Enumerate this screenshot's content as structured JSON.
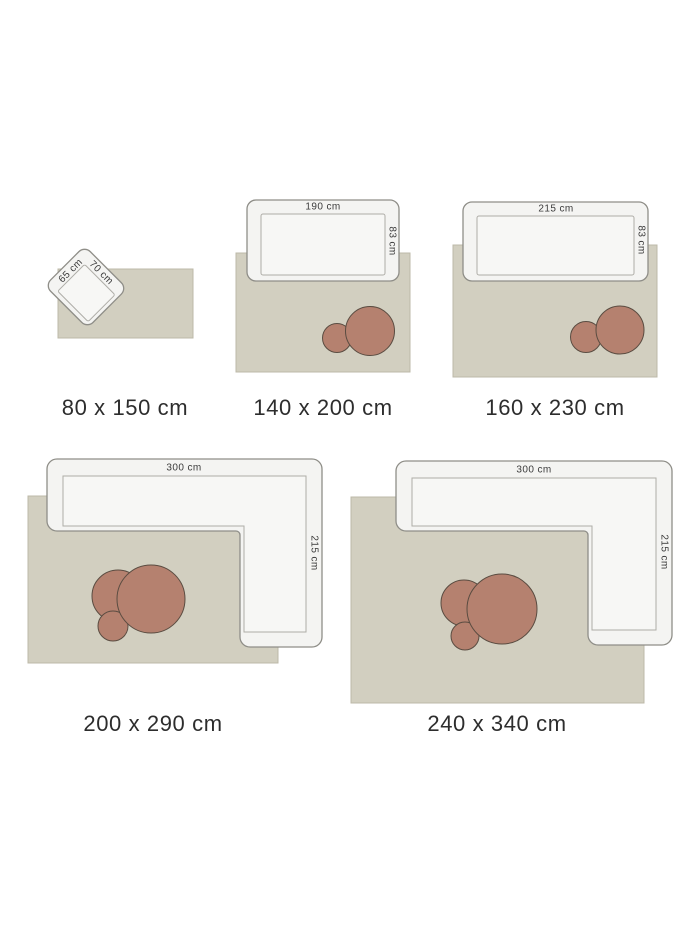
{
  "title": "Rug size guide with furniture for scale",
  "colors": {
    "background": "#ffffff",
    "rug": "#d2cfc0",
    "rug_border": "#bcb9a8",
    "furniture_fill": "#f4f4f2",
    "seat_fill": "#f7f7f5",
    "furniture_border": "#8f8e88",
    "inner_border": "#aeada7",
    "table_fill": "#b5816f",
    "table_border": "#5a4c41",
    "dimension_label": "#3c3c3c",
    "caption": "#2d2d2d"
  },
  "configs": [
    {
      "id": "80x150",
      "caption": "80 x 150 cm",
      "rug": {
        "x": 58,
        "y": 269,
        "w": 135,
        "h": 69
      },
      "furniture": {
        "type": "armchair",
        "cx": 86,
        "cy": 287,
        "w": 60,
        "h": 56,
        "rotate": 45,
        "inner": {
          "x": -17,
          "y": -15,
          "w": 43,
          "h": 38
        }
      },
      "tables": [],
      "labels": [
        {
          "text": "70 cm",
          "x": 101,
          "y": 273,
          "rotate": 45
        },
        {
          "text": "65 cm",
          "x": 71,
          "y": 271,
          "rotate": -45
        }
      ]
    },
    {
      "id": "140x200",
      "caption": "140 x 200 cm",
      "rug": {
        "x": 236,
        "y": 253,
        "w": 174,
        "h": 119
      },
      "furniture": {
        "type": "sofa",
        "x": 247,
        "y": 200,
        "w": 152,
        "h": 81,
        "inner": {
          "x": 261,
          "y": 214,
          "w": 124,
          "h": 61
        }
      },
      "tables": [
        {
          "cx": 337,
          "cy": 338,
          "r": 14.5
        },
        {
          "cx": 370,
          "cy": 331,
          "r": 24.5
        }
      ],
      "labels": [
        {
          "text": "190 cm",
          "x": 323,
          "y": 207,
          "rotate": 0
        },
        {
          "text": "83 cm",
          "x": 392,
          "y": 241,
          "rotate": 90
        }
      ]
    },
    {
      "id": "160x230",
      "caption": "160 x 230 cm",
      "rug": {
        "x": 453,
        "y": 245,
        "w": 204,
        "h": 132
      },
      "furniture": {
        "type": "sofa",
        "x": 463,
        "y": 202,
        "w": 185,
        "h": 79,
        "inner": {
          "x": 477,
          "y": 216,
          "w": 157,
          "h": 59
        }
      },
      "tables": [
        {
          "cx": 586,
          "cy": 337,
          "r": 15.5
        },
        {
          "cx": 620,
          "cy": 330,
          "r": 24
        }
      ],
      "labels": [
        {
          "text": "215 cm",
          "x": 556,
          "y": 209,
          "rotate": 0
        },
        {
          "text": "83 cm",
          "x": 641,
          "y": 240,
          "rotate": 90
        }
      ]
    },
    {
      "id": "200x290",
      "caption": "200 x 290 cm",
      "rug": {
        "x": 28,
        "y": 496,
        "w": 250,
        "h": 167
      },
      "furniture": {
        "type": "sectional",
        "outer_path": "M 57 459 H 312 A 10 10 0 0 1 322 469 V 637 A 10 10 0 0 1 312 647 H 250 A 10 10 0 0 1 240 637 V 535 A 4 4 0 0 0 236 531 H 57 A 10 10 0 0 1 47 521 V 469 A 10 10 0 0 1 57 459 Z",
        "inner_path": "M 63 476 H 306 V 632 H 244 V 526 H 63 Z"
      },
      "tables": [
        {
          "cx": 118,
          "cy": 596,
          "r": 26
        },
        {
          "cx": 113,
          "cy": 626,
          "r": 15
        },
        {
          "cx": 151,
          "cy": 599,
          "r": 34
        }
      ],
      "labels": [
        {
          "text": "300 cm",
          "x": 184,
          "y": 468,
          "rotate": 0
        },
        {
          "text": "215 cm",
          "x": 314,
          "y": 553,
          "rotate": 90
        }
      ]
    },
    {
      "id": "240x340",
      "caption": "240 x 340 cm",
      "rug": {
        "x": 351,
        "y": 497,
        "w": 293,
        "h": 206
      },
      "furniture": {
        "type": "sectional",
        "outer_path": "M 406 461 H 662 A 10 10 0 0 1 672 471 V 635 A 10 10 0 0 1 662 645 H 598 A 10 10 0 0 1 588 635 V 535 A 4 4 0 0 0 584 531 H 406 A 10 10 0 0 1 396 521 V 471 A 10 10 0 0 1 406 461 Z",
        "inner_path": "M 412 478 H 656 V 630 H 592 V 526 H 412 Z"
      },
      "tables": [
        {
          "cx": 464,
          "cy": 603,
          "r": 23
        },
        {
          "cx": 465,
          "cy": 636,
          "r": 14
        },
        {
          "cx": 502,
          "cy": 609,
          "r": 35
        }
      ],
      "labels": [
        {
          "text": "300 cm",
          "x": 534,
          "y": 470,
          "rotate": 0
        },
        {
          "text": "215 cm",
          "x": 664,
          "y": 552,
          "rotate": 90
        }
      ]
    }
  ]
}
